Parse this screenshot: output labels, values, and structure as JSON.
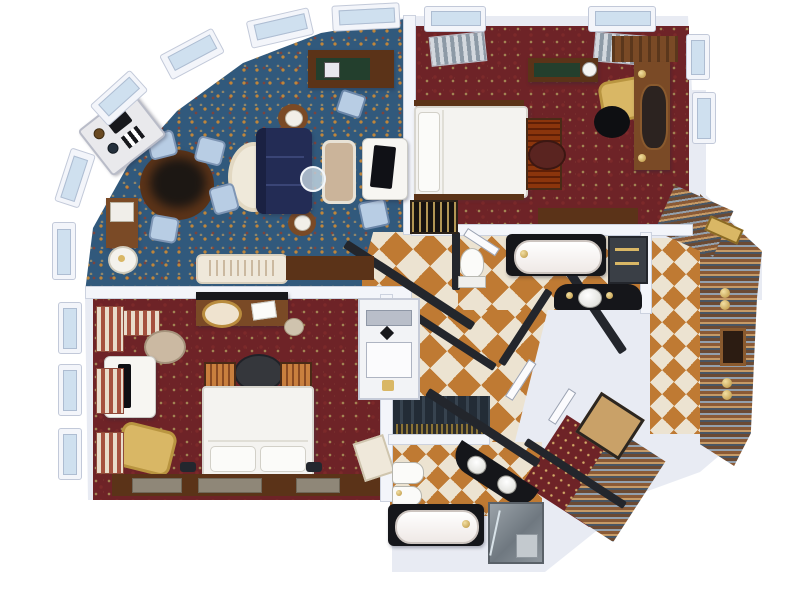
{
  "scene": {
    "kind": "3d-rendered floor plan, top-down view",
    "subject": "two-bedroom luxury suite with living room, two bathrooms, dressing corridor and entry foyer",
    "visible_text": []
  },
  "palette": {
    "paper": "#ffffff",
    "wall-light": "#e8ebf3",
    "wall-white": "#f3f5fa",
    "hall-wall": "#23262c",
    "carpet-blue": "#31597c",
    "carpet-blue-pattern": "#c98a33",
    "carpet-red": "#6e2327",
    "carpet-red-pattern": "#a3905a",
    "tile-orange": "#bf7a33",
    "tile-white": "#ece3d1",
    "wood-dark": "#5b3318",
    "wood-mid": "#7a4a26",
    "sofa-navy": "#232c55",
    "chair-gold": "#d9b765",
    "chair-blue": "#b8cde4",
    "bed-white": "#f4f3f0",
    "cabinet-green": "#233f2d",
    "glass": "#cfe0ef",
    "gold": "#d9b765",
    "fixture-black": "#15161a"
  },
  "rooms": {
    "living_room": {
      "floor": "blue-gold ornate carpet"
    },
    "master_bedroom": {
      "floor": "red-gold ornate carpet"
    },
    "second_bedroom": {
      "floor": "red-gold ornate carpet"
    },
    "hallway": {
      "floor": "orange-white diamond checker tile"
    },
    "master_bathroom": {
      "floor": "checker tile"
    },
    "second_bathroom": {
      "floor": "checker tile"
    },
    "dressing_corridor": {
      "floor": "multicolor striped runner"
    },
    "entry_foyer": {
      "floor": "dark striped mat"
    }
  }
}
